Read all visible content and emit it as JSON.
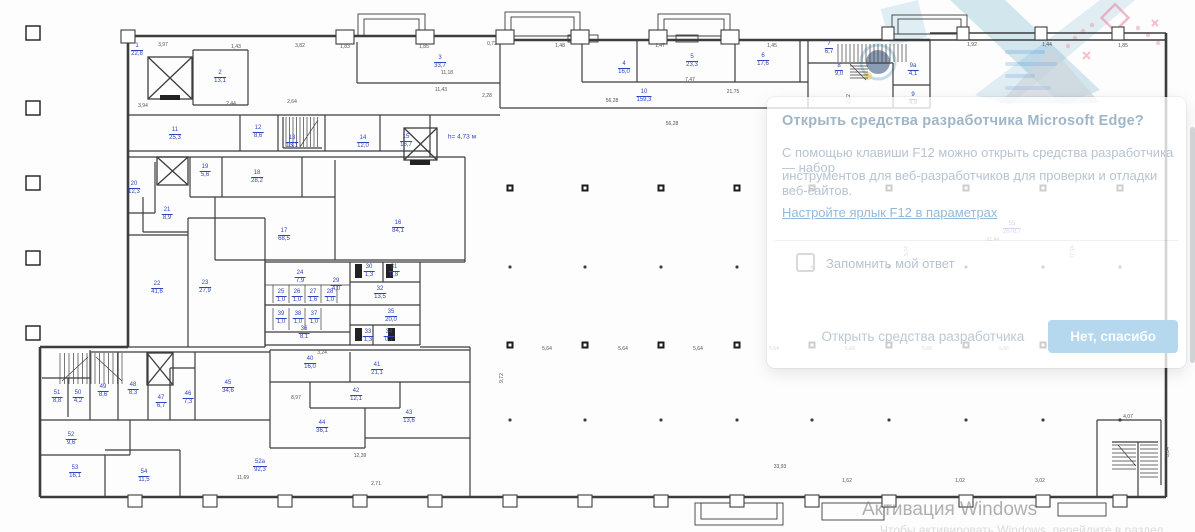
{
  "dialog": {
    "title": "Открыть средства разработчика Microsoft Edge?",
    "body_line1": "С помощью клавиши F12 можно открыть средства разработчика — набор",
    "body_line2": "инструментов для веб-разработчиков для проверки и отладки веб-сайтов.",
    "link": "Настройте ярлык F12 в параметрах",
    "checkbox_label": "Запомнить мой ответ",
    "secondary_button": "Открыть средства разработчика",
    "primary_button": "Нет, спасибо",
    "primary_button_color": "#b5d8ee",
    "checkbox_checked": false
  },
  "watermark": {
    "line1": "Активация Windows",
    "line2": "Чтобы активировать Windows, перейдите в раздел \"Параметры\"."
  },
  "plan": {
    "height_note": {
      "t": "h= 4,73 м",
      "x": 462,
      "y": 137
    },
    "label_color": "#2f45bb",
    "rooms": [
      {
        "num": "1",
        "area": "22,8",
        "x": 137,
        "y": 50
      },
      {
        "num": "2",
        "area": "13,1",
        "x": 220,
        "y": 77
      },
      {
        "num": "3",
        "area": "33,7",
        "x": 440,
        "y": 62
      },
      {
        "num": "4",
        "area": "16,0",
        "x": 624,
        "y": 68
      },
      {
        "num": "5",
        "area": "23,3",
        "x": 692,
        "y": 61
      },
      {
        "num": "6",
        "area": "17,6",
        "x": 763,
        "y": 60
      },
      {
        "num": "7",
        "area": "6,7",
        "x": 829,
        "y": 48
      },
      {
        "num": "8",
        "area": "9,0",
        "x": 839,
        "y": 70
      },
      {
        "num": "9а",
        "area": "4,1",
        "x": 913,
        "y": 70
      },
      {
        "num": "9",
        "area": "4,9",
        "x": 913,
        "y": 99
      },
      {
        "num": "10",
        "area": "159,3",
        "x": 644,
        "y": 96
      },
      {
        "num": "11",
        "area": "25,3",
        "x": 175,
        "y": 134
      },
      {
        "num": "12",
        "area": "8,6",
        "x": 258,
        "y": 132
      },
      {
        "num": "13",
        "area": "13,1",
        "x": 292,
        "y": 142
      },
      {
        "num": "14",
        "area": "12,0",
        "x": 363,
        "y": 142
      },
      {
        "num": "15",
        "area": "16,7",
        "x": 406,
        "y": 141
      },
      {
        "num": "16",
        "area": "84,1",
        "x": 398,
        "y": 227
      },
      {
        "num": "17",
        "area": "68,5",
        "x": 284,
        "y": 235
      },
      {
        "num": "18",
        "area": "28,2",
        "x": 257,
        "y": 177
      },
      {
        "num": "19",
        "area": "5,6",
        "x": 205,
        "y": 171
      },
      {
        "num": "20",
        "area": "12,3",
        "x": 134,
        "y": 188
      },
      {
        "num": "21",
        "area": "8,9",
        "x": 167,
        "y": 214
      },
      {
        "num": "22",
        "area": "41,6",
        "x": 157,
        "y": 288
      },
      {
        "num": "23",
        "area": "27,9",
        "x": 205,
        "y": 287
      },
      {
        "num": "24",
        "area": "7,9",
        "x": 300,
        "y": 277
      },
      {
        "num": "25",
        "area": "1,0",
        "x": 281,
        "y": 296
      },
      {
        "num": "26",
        "area": "1,0",
        "x": 297,
        "y": 296
      },
      {
        "num": "27",
        "area": "1,6",
        "x": 313,
        "y": 296
      },
      {
        "num": "28",
        "area": "1,0",
        "x": 330,
        "y": 296
      },
      {
        "num": "29",
        "area": "4,0",
        "x": 336,
        "y": 285
      },
      {
        "num": "30",
        "area": "1,3",
        "x": 369,
        "y": 271
      },
      {
        "num": "31",
        "area": "0,8",
        "x": 394,
        "y": 271
      },
      {
        "num": "32",
        "area": "13,5",
        "x": 380,
        "y": 293
      },
      {
        "num": "35",
        "area": "20,0",
        "x": 391,
        "y": 316
      },
      {
        "num": "33",
        "area": "1,3",
        "x": 368,
        "y": 336
      },
      {
        "num": "34",
        "area": "0,7",
        "x": 389,
        "y": 336
      },
      {
        "num": "36",
        "area": "8,1",
        "x": 304,
        "y": 333
      },
      {
        "num": "37",
        "area": "1,0",
        "x": 314,
        "y": 318
      },
      {
        "num": "38",
        "area": "1,0",
        "x": 298,
        "y": 318
      },
      {
        "num": "39",
        "area": "1,0",
        "x": 281,
        "y": 318
      },
      {
        "num": "40",
        "area": "16,0",
        "x": 310,
        "y": 363
      },
      {
        "num": "41",
        "area": "21,1",
        "x": 377,
        "y": 369
      },
      {
        "num": "42",
        "area": "12,1",
        "x": 356,
        "y": 395
      },
      {
        "num": "43",
        "area": "13,6",
        "x": 409,
        "y": 417
      },
      {
        "num": "44",
        "area": "36,1",
        "x": 322,
        "y": 427
      },
      {
        "num": "45",
        "area": "34,6",
        "x": 228,
        "y": 387
      },
      {
        "num": "46",
        "area": "7,3",
        "x": 188,
        "y": 398
      },
      {
        "num": "47",
        "area": "6,7",
        "x": 161,
        "y": 402
      },
      {
        "num": "48",
        "area": "8,3",
        "x": 133,
        "y": 389
      },
      {
        "num": "49",
        "area": "8,6",
        "x": 103,
        "y": 391
      },
      {
        "num": "50",
        "area": "4,2",
        "x": 78,
        "y": 397
      },
      {
        "num": "51",
        "area": "8,8",
        "x": 57,
        "y": 397
      },
      {
        "num": "52",
        "area": "9,6",
        "x": 71,
        "y": 439
      },
      {
        "num": "53",
        "area": "16,1",
        "x": 75,
        "y": 472
      },
      {
        "num": "54",
        "area": "11,5",
        "x": 144,
        "y": 476
      },
      {
        "num": "52а",
        "area": "92,3",
        "x": 260,
        "y": 466
      },
      {
        "num": "55",
        "area": "2678,7",
        "x": 1012,
        "y": 228
      }
    ],
    "dims": [
      {
        "t": "3,97",
        "x": 163,
        "y": 45
      },
      {
        "t": "1,43",
        "x": 236,
        "y": 47
      },
      {
        "t": "3,82",
        "x": 300,
        "y": 46
      },
      {
        "t": "1,83",
        "x": 345,
        "y": 47
      },
      {
        "t": "1,85",
        "x": 424,
        "y": 47
      },
      {
        "t": "0,72",
        "x": 492,
        "y": 44
      },
      {
        "t": "1,48",
        "x": 560,
        "y": 46
      },
      {
        "t": "1,47",
        "x": 660,
        "y": 46
      },
      {
        "t": "1,45",
        "x": 772,
        "y": 46
      },
      {
        "t": "1,92",
        "x": 972,
        "y": 45
      },
      {
        "t": "1,44",
        "x": 1047,
        "y": 45
      },
      {
        "t": "1,85",
        "x": 1123,
        "y": 46
      },
      {
        "t": "11,18",
        "x": 447,
        "y": 73
      },
      {
        "t": "11,43",
        "x": 441,
        "y": 90
      },
      {
        "t": "2,28",
        "x": 487,
        "y": 96
      },
      {
        "t": "56,28",
        "x": 612,
        "y": 101
      },
      {
        "t": "56,28",
        "x": 672,
        "y": 124
      },
      {
        "t": "7,47",
        "x": 690,
        "y": 80
      },
      {
        "t": "21,75",
        "x": 733,
        "y": 92
      },
      {
        "t": "2,64",
        "x": 292,
        "y": 102
      },
      {
        "t": "3,94",
        "x": 143,
        "y": 106
      },
      {
        "t": "2,44",
        "x": 231,
        "y": 104
      },
      {
        "t": "61,44",
        "x": 993,
        "y": 240
      },
      {
        "t": "77,14",
        "x": 1073,
        "y": 252,
        "r": 1
      },
      {
        "t": "9,72",
        "x": 502,
        "y": 378,
        "r": 1
      },
      {
        "t": "9,74",
        "x": 907,
        "y": 251,
        "r": 1
      },
      {
        "t": "2,22",
        "x": 849,
        "y": 99,
        "r": 1
      },
      {
        "t": "5,64",
        "x": 547,
        "y": 349
      },
      {
        "t": "5,64",
        "x": 623,
        "y": 349
      },
      {
        "t": "5,64",
        "x": 698,
        "y": 349
      },
      {
        "t": "5,64",
        "x": 774,
        "y": 349
      },
      {
        "t": "5,64",
        "x": 850,
        "y": 349
      },
      {
        "t": "5,68",
        "x": 927,
        "y": 349
      },
      {
        "t": "5,66",
        "x": 1004,
        "y": 349
      },
      {
        "t": "5,64",
        "x": 1081,
        "y": 349
      },
      {
        "t": "5,62",
        "x": 1152,
        "y": 349
      },
      {
        "t": "33,93",
        "x": 780,
        "y": 467
      },
      {
        "t": "12,39",
        "x": 360,
        "y": 456
      },
      {
        "t": "11,69",
        "x": 243,
        "y": 478
      },
      {
        "t": "2,71",
        "x": 376,
        "y": 484
      },
      {
        "t": "8,97",
        "x": 296,
        "y": 398
      },
      {
        "t": "3,24",
        "x": 322,
        "y": 353
      },
      {
        "t": "1,62",
        "x": 847,
        "y": 481
      },
      {
        "t": "1,02",
        "x": 960,
        "y": 481
      },
      {
        "t": "3,02",
        "x": 1040,
        "y": 481
      },
      {
        "t": "4,07",
        "x": 1128,
        "y": 417
      },
      {
        "t": "3,34",
        "x": 1168,
        "y": 452,
        "r": 1
      }
    ],
    "hall_columns": {
      "xs": [
        510,
        585,
        661,
        737,
        812,
        889,
        966,
        1043,
        1120
      ],
      "square_rows": [
        188,
        345
      ],
      "dot_rows": [
        267,
        420
      ]
    }
  }
}
